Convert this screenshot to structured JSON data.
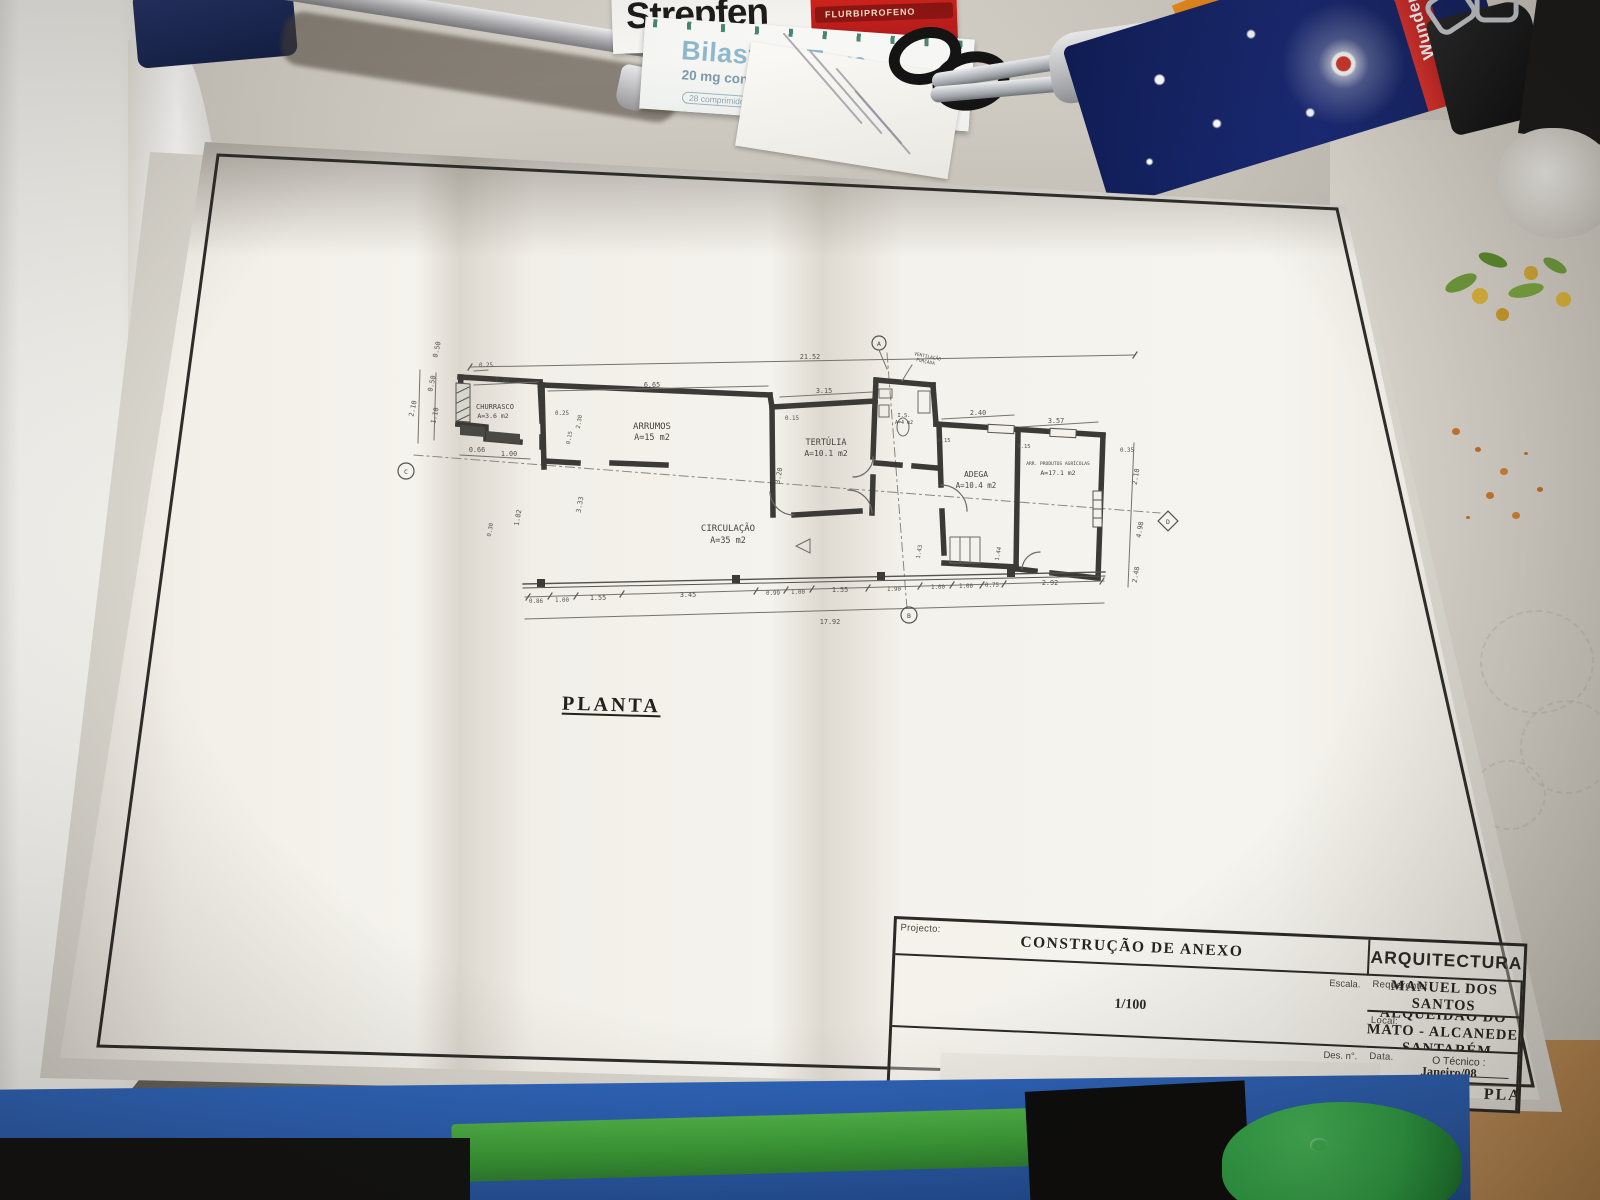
{
  "surroundings": {
    "strepfen": {
      "brand": "Strepfen",
      "substrip": "FLURBIPROFENO"
    },
    "bilastina": {
      "brand": "Bilastina Teva",
      "dose": "20 mg comprimidos",
      "badge": "MG",
      "count": "28 comprimidos"
    },
    "sparklers": {
      "brand": "Wunderkerzen",
      "tagline1": "Electric",
      "tagline2": "Sparklers"
    }
  },
  "drawing": {
    "caption": "PLANTA",
    "note_line1": "VENTILAÇÃO",
    "note_line2": "FORÇADA",
    "rooms": [
      {
        "name": "CHURRASCO",
        "area": "A=3.6 m2"
      },
      {
        "name": "ARRUMOS",
        "area": "A=15 m2"
      },
      {
        "name": "TERTÚLIA",
        "area": "A=10.1 m2"
      },
      {
        "name": "I.S.",
        "area": "A=4 m2"
      },
      {
        "name": "ADEGA",
        "area": "A=10.4 m2"
      },
      {
        "name": "ARR. PRODUTOS AGRÍCOLAS",
        "area": "A=17.1 m2"
      },
      {
        "name": "CIRCULAÇÃO",
        "area": "A=35 m2"
      }
    ],
    "dims_top": [
      "21.52",
      "6.65",
      "3.15",
      "2.40",
      "3.57",
      "0.25",
      "2.25"
    ],
    "dims_left": [
      "0.50",
      "2.10",
      "0.50",
      "1.10",
      "0.66",
      "1.00"
    ],
    "dims_inner": [
      "0.25",
      "2.30",
      "0.15",
      "3.33",
      "1.02",
      "0.30",
      "0.15",
      "3.20",
      "0.15",
      "0.15",
      "1.43",
      "1.44"
    ],
    "dims_right": [
      "0.35",
      "2.10",
      "4.98",
      "2.48"
    ],
    "dims_bottom": [
      "0.86",
      "1.00",
      "1.55",
      "3.45",
      "0.99",
      "1.00",
      "1.55",
      "1.90",
      "1.00",
      "1.00",
      "0.75",
      "2.92",
      "17.92"
    ],
    "markers": {
      "top": "A",
      "bottom": "B",
      "left": "C",
      "right": "D"
    },
    "titleblock": {
      "project_label": "Projecto:",
      "project": "CONSTRUÇÃO DE ANEXO",
      "discipline": "ARQUITECTURA",
      "client_label": "Requerente:",
      "client": "FERNANDO MANUEL DOS SANTOS CORDEIRO",
      "scale_label": "Escala.",
      "scale": "1/100",
      "location_label": "Local:",
      "location": "ALQUEIDÃO DO MATO - ALCANEDE - SANTARÉM",
      "date_label": "Data.",
      "date": "Janeiro/08",
      "technician_label": "O Técnico :",
      "number_label": "Des. n°.",
      "number": "2",
      "piece_label": "Peça desenhada.",
      "piece": "PLANTA"
    }
  },
  "colors": {
    "paper": "#f4f1ea",
    "plan_line": "#3b3a37",
    "folder_blue": "#2f66bd",
    "lid_green": "#2f9e44",
    "sparkler_navy": "#1a2b78",
    "sparkler_red": "#d8232a",
    "strepfen_red": "#e2261f",
    "teva_blue": "#8fb8cc"
  }
}
